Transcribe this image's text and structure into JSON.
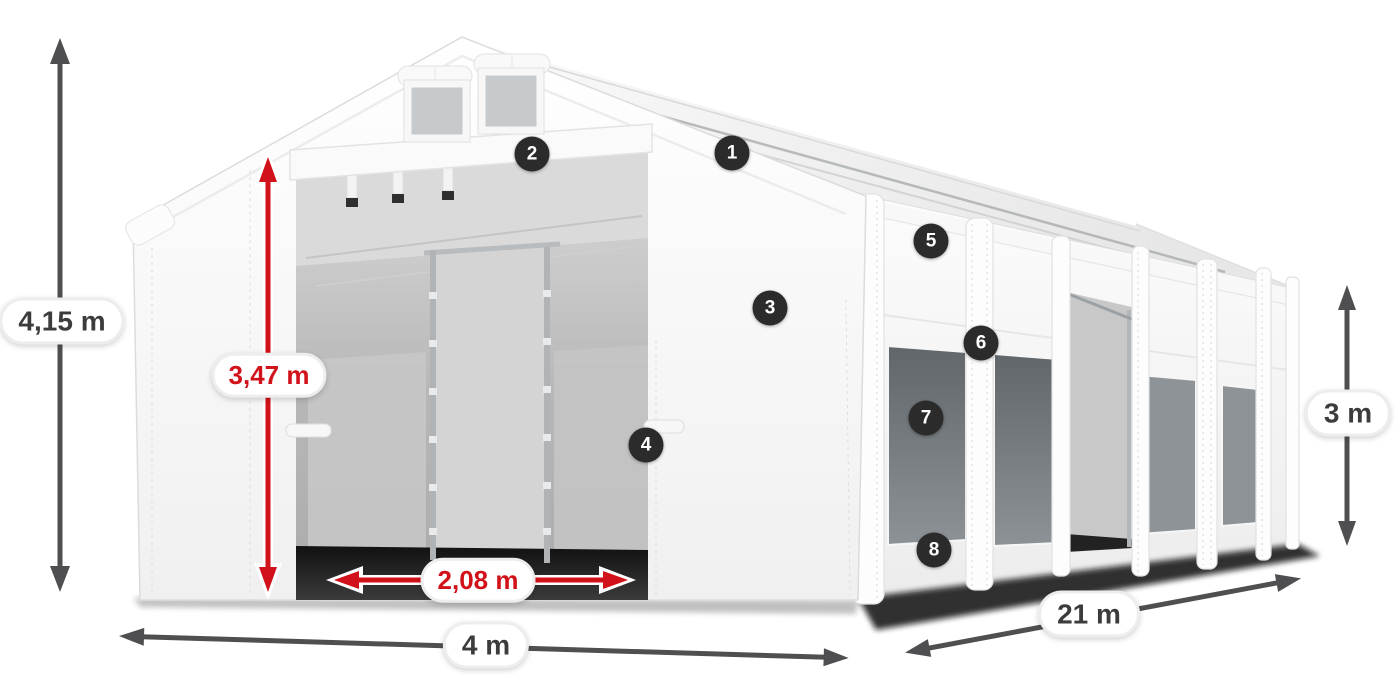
{
  "diagram": {
    "dimensions": {
      "total_height": {
        "label": "4,15 m",
        "style": "dark"
      },
      "inner_height": {
        "label": "3,47 m",
        "style": "red"
      },
      "door_width": {
        "label": "2,08 m",
        "style": "red"
      },
      "width": {
        "label": "4 m",
        "style": "dark"
      },
      "length": {
        "label": "21 m",
        "style": "dark"
      },
      "side_height": {
        "label": "3 m",
        "style": "dark"
      }
    },
    "callouts": [
      {
        "number": "1"
      },
      {
        "number": "2"
      },
      {
        "number": "3"
      },
      {
        "number": "4"
      },
      {
        "number": "5"
      },
      {
        "number": "6"
      },
      {
        "number": "7"
      },
      {
        "number": "8"
      }
    ],
    "colors": {
      "arrow_dark": "#4f4f51",
      "arrow_red": "#d2121a",
      "badge_bg": "#2b2b2b",
      "badge_text": "#ffffff",
      "pill_bg": "#ffffff",
      "pill_border": "#ededed",
      "pill_text_dark": "#3c3c3e",
      "pill_text_red": "#d2121a",
      "tent_white": "#f7f7f7"
    }
  }
}
